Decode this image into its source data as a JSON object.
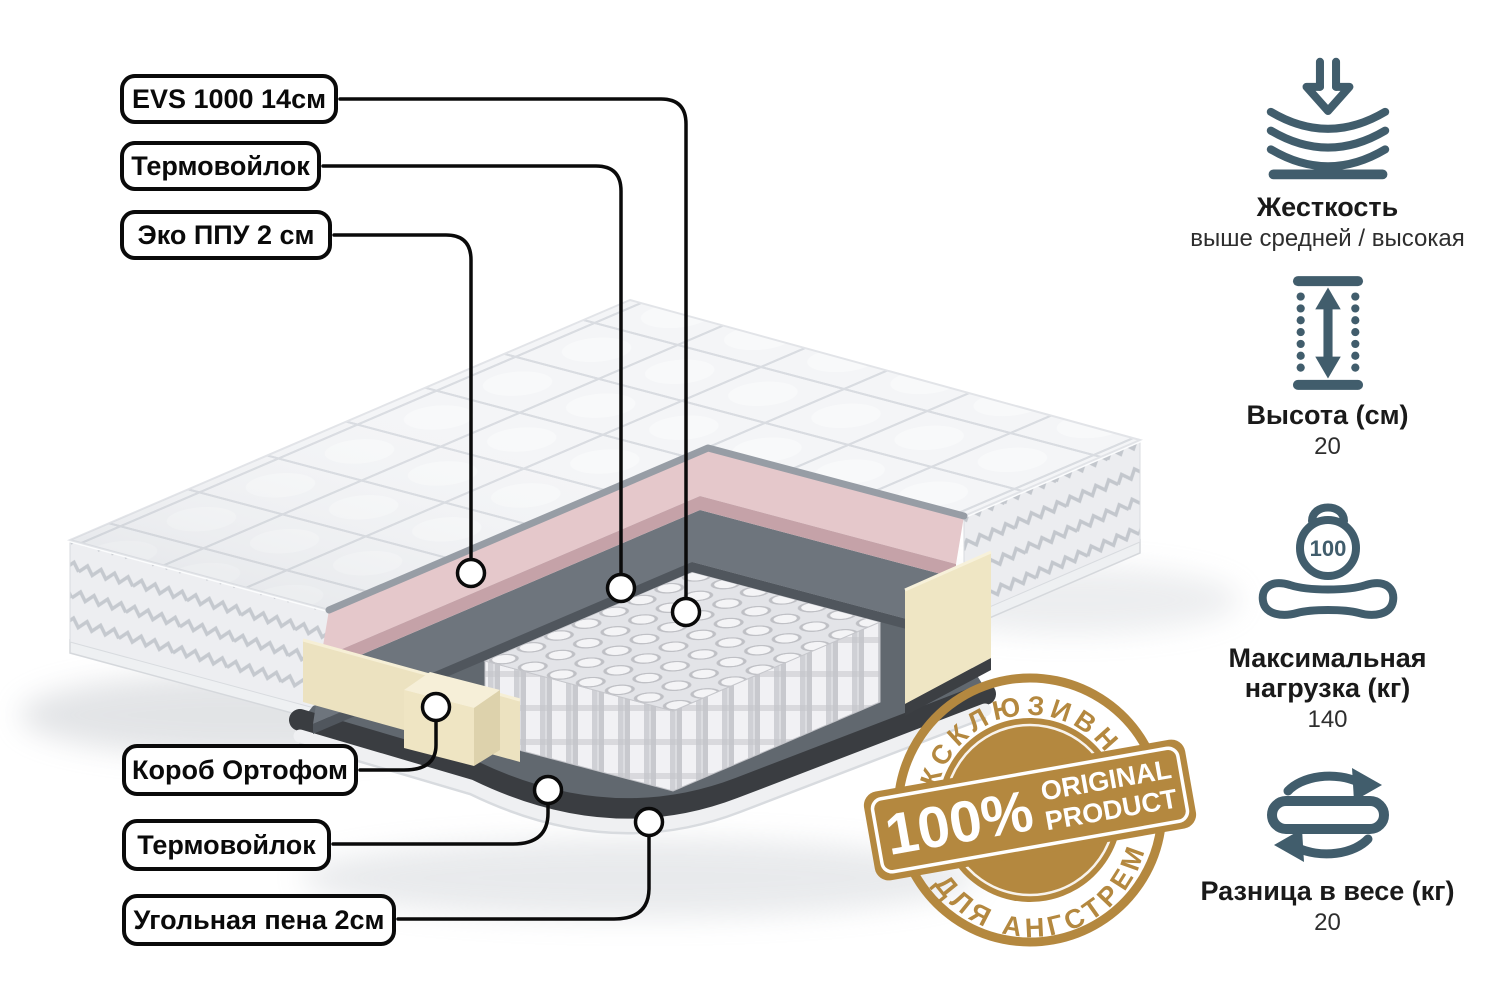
{
  "title": "Схема слоёв матраса",
  "callouts": [
    {
      "id": "evs",
      "label": "EVS 1000 14см"
    },
    {
      "id": "thermo_top",
      "label": "Термовойлок"
    },
    {
      "id": "eko_ppu",
      "label": "Эко ППУ 2 см"
    },
    {
      "id": "korob",
      "label": "Короб Ортофом"
    },
    {
      "id": "thermo_bottom",
      "label": "Термовойлок"
    },
    {
      "id": "ugol",
      "label": "Угольная пена 2см"
    }
  ],
  "features": [
    {
      "id": "firmness",
      "icon": "compression-arrow-icon",
      "label": "Жесткость",
      "value": "выше средней / высокая"
    },
    {
      "id": "height",
      "icon": "height-arrows-icon",
      "label": "Высота (см)",
      "value": "20"
    },
    {
      "id": "max_load",
      "icon": "kettlebell-icon",
      "label": "Максимальная нагрузка (кг)",
      "value": "140",
      "icon_text": "100"
    },
    {
      "id": "weight_diff",
      "icon": "rotate-flip-icon",
      "label": "Разница в весе (кг)",
      "value": "20"
    }
  ],
  "badge": {
    "arc_top": "ЭКСКЛЮЗИВНО",
    "arc_bottom": "ДЛЯ АНГСТРЕМ",
    "percent": "100%",
    "line1": "ORIGINAL",
    "line2": "PRODUCT",
    "color": "#b4883f"
  },
  "colors": {
    "icon_accent": "#415d6c",
    "badge_gold": "#b4883f",
    "pink_layer": "#e5c8cb",
    "felt_layer": "#61686f",
    "foam_cream": "#efe6c4",
    "charcoal_layer": "#3a3d41",
    "line_black": "#0a0a0a"
  }
}
